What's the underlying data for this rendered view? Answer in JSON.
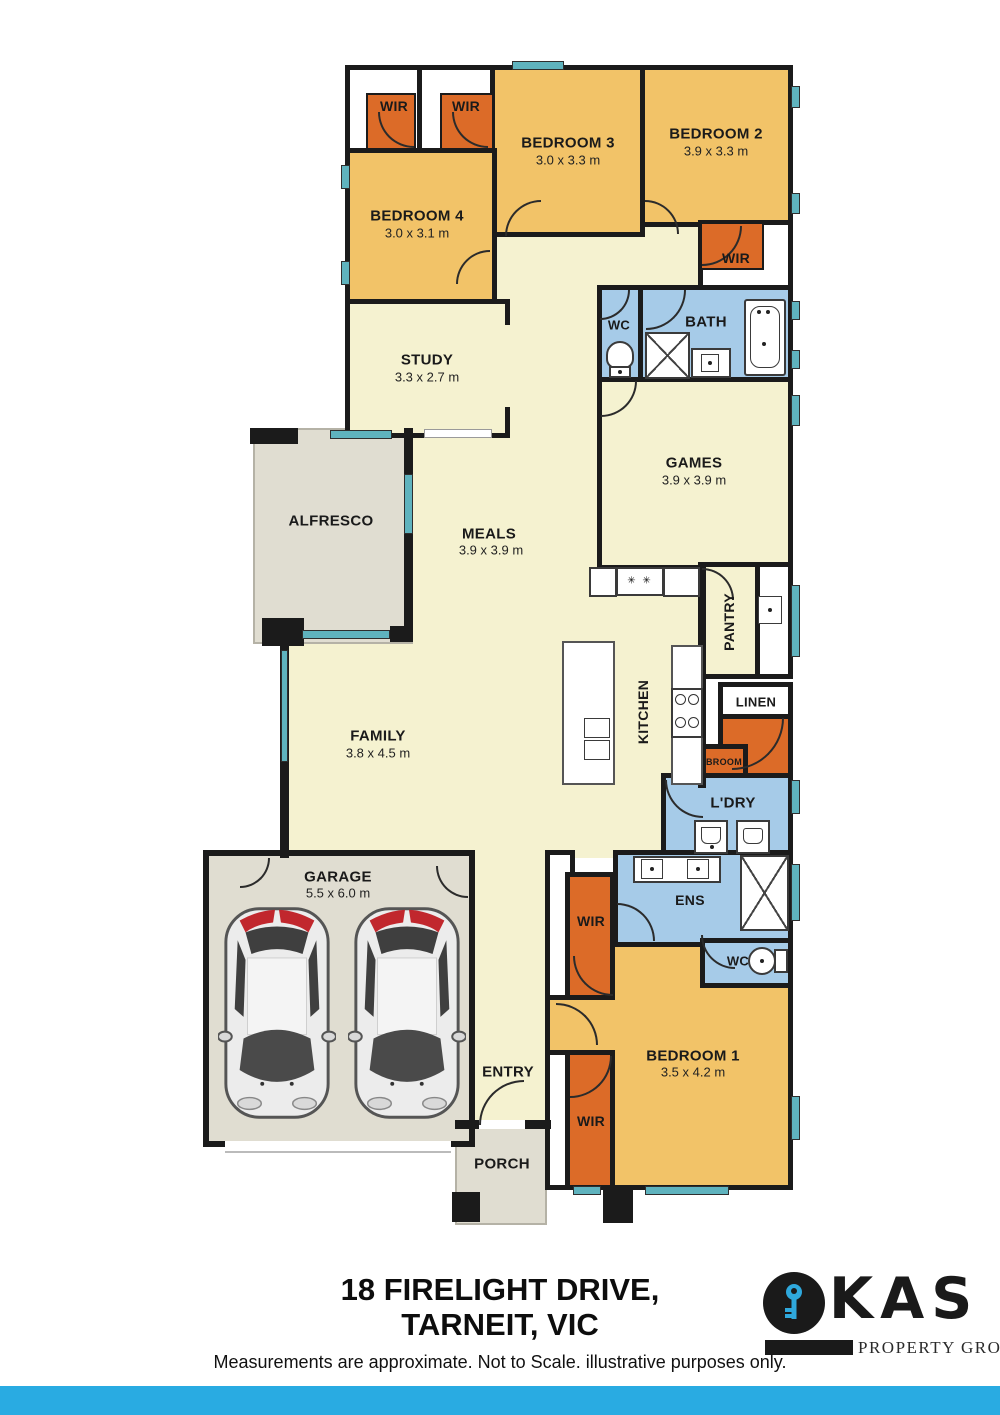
{
  "rooms": {
    "wir_top_left": {
      "label": "WIR"
    },
    "wir_top_mid": {
      "label": "WIR"
    },
    "bedroom3": {
      "label": "BEDROOM 3",
      "dims": "3.0 x 3.3 m"
    },
    "bedroom2": {
      "label": "BEDROOM 2",
      "dims": "3.9 x 3.3 m"
    },
    "bedroom4": {
      "label": "BEDROOM 4",
      "dims": "3.0 x 3.1 m"
    },
    "wir_bed2": {
      "label": "WIR"
    },
    "study": {
      "label": "STUDY",
      "dims": "3.3 x 2.7 m"
    },
    "wc_main": {
      "label": "WC"
    },
    "bath": {
      "label": "BATH"
    },
    "games": {
      "label": "GAMES",
      "dims": "3.9 x 3.9 m"
    },
    "alfresco": {
      "label": "ALFRESCO"
    },
    "meals": {
      "label": "MEALS",
      "dims": "3.9 x 3.9 m"
    },
    "pantry": {
      "label": "PANTRY"
    },
    "kitchen": {
      "label": "KITCHEN"
    },
    "linen": {
      "label": "LINEN"
    },
    "broom": {
      "label": "BROOM"
    },
    "laundry": {
      "label": "L'DRY"
    },
    "family": {
      "label": "FAMILY",
      "dims": "3.8 x 4.5 m"
    },
    "garage": {
      "label": "GARAGE",
      "dims": "5.5 x 6.0 m"
    },
    "ens": {
      "label": "ENS"
    },
    "wc_ens": {
      "label": "WC"
    },
    "wir_ens": {
      "label": "WIR"
    },
    "bedroom1": {
      "label": "BEDROOM 1",
      "dims": "3.5 x 4.2 m"
    },
    "entry": {
      "label": "ENTRY"
    },
    "porch": {
      "label": "PORCH"
    },
    "wir_bed1": {
      "label": "WIR"
    }
  },
  "icons": {
    "burners": "✳ ✳"
  },
  "footer": {
    "address_line1": "18 FIRELIGHT DRIVE,",
    "address_line2": "TARNEIT, VIC",
    "disclaimer": "Measurements are approximate. Not to Scale. illustrative purposes only."
  },
  "logo": {
    "letters": "KAS",
    "tagline": "PROPERTY GROUP"
  },
  "colors": {
    "wall": "#1b1b1b",
    "bedroom": "#F2C368",
    "living": "#F5F2D0",
    "wet_area": "#A6CBE8",
    "robe_orange": "#DC6B28",
    "outdoor_gray": "#E0DDD1",
    "window_teal": "#5FB3BE",
    "footer_bar": "#29ABE2",
    "logo_key_blue": "#2FA8DC"
  }
}
